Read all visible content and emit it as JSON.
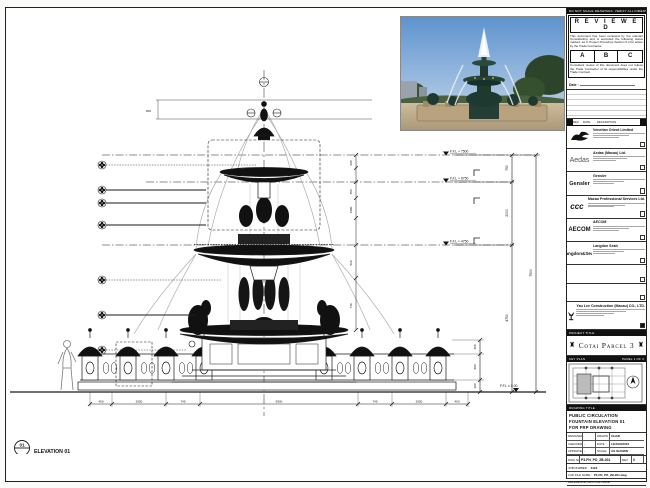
{
  "sheet": {
    "top_note": "DO NOT SCALE DRAWINGS. VERIFY ALL DIMENSIONS ON SITE.",
    "stamp": {
      "title": "R E V I E W E D",
      "body1": "This document has been reviewed by the relevant Consultant(s) and is accorded the following status marked, as in Project Procedure Section 5.4 for action by the Trade Contractor.",
      "grades": [
        "A",
        "B",
        "C"
      ],
      "body2": "Consultant review of this document does not relieve the Trade Contractor of its responsibilities under the Trade Contract.",
      "date_label": "Date :"
    },
    "revision_header": {
      "rev": "REV",
      "date": "DATE",
      "description": "DESCRIPTION"
    }
  },
  "consultants": [
    {
      "logo": "winged-lion",
      "name": "Venetian Orient Limited"
    },
    {
      "logo": "Aedas",
      "name": "Aedas (Macau) Ltd."
    },
    {
      "logo": "Gensler",
      "name": "Gensler"
    },
    {
      "logo": "ccc",
      "name": "Macau Professional Services Ltd."
    },
    {
      "logo": "AECOM",
      "name": "AECOM"
    },
    {
      "logo": "Langdon&Seah",
      "name": "Langdon Seah"
    }
  ],
  "contractor": {
    "name": "Yau Lee Construction (Macau) CO., LTD."
  },
  "project": {
    "label": "PROJECT TITLE",
    "name": "Cotai Parcel 3"
  },
  "key_plan": {
    "label": "KEY PLAN",
    "panel": "PANEL 1 OF 3"
  },
  "drawing": {
    "label": "DRAWING TITLE",
    "line1": "PUBLIC CIRCULATION",
    "line2": "FOUNTAIN ELEVATION 01",
    "line3": "FOR FRP DRAWING"
  },
  "info": {
    "designed_label": "DESIGNED",
    "designed": "",
    "drawn_label": "DRAWN",
    "drawn": "CHAD",
    "checked_label": "CHECKED",
    "checked": "-",
    "date_label": "DATE",
    "date": "12/JAN/2016",
    "approved_label": "APPROVED",
    "approved": "-",
    "scale_label": "SCALE",
    "scale": "AS SHOWN",
    "dwg_no_label": "DWG NO.",
    "dwg_no": "P3-FN_PD_2B-001",
    "rev_label": "REV",
    "rev": "0",
    "job_label": "JOB NUMBER :",
    "job": "3123",
    "cad_label": "CAD FILE NAME :",
    "cad": "P3-FN_PD_2B-001.dwg",
    "ref_label": "REFERENCE DWG FILE NAME :",
    "ref": ""
  },
  "elevation": {
    "number": "01",
    "title": "ELEVATION 01",
    "scale": "SCALE 1:25"
  },
  "levels": [
    {
      "label": "F.F.L + 7500"
    },
    {
      "label": "F.F.L + 6750"
    },
    {
      "label": "F.F.L + 4750"
    },
    {
      "label": "F.F.L ± 0.00"
    }
  ],
  "dims": {
    "top": "600",
    "right": [
      "750",
      "2000",
      "4750",
      "7500"
    ],
    "inner": [
      "690",
      "450",
      "1980",
      "520",
      "740"
    ],
    "lantern": [
      "450",
      "800",
      "300"
    ],
    "bottom": [
      "450",
      "2050",
      "745",
      "5900",
      "745",
      "2050",
      "450"
    ]
  },
  "colors": {
    "line": "#1a1a1a",
    "water": "#aeaeae",
    "sky": "#6f9fd4",
    "foliage": "#2c452a",
    "stone": "#c2ae8a"
  }
}
